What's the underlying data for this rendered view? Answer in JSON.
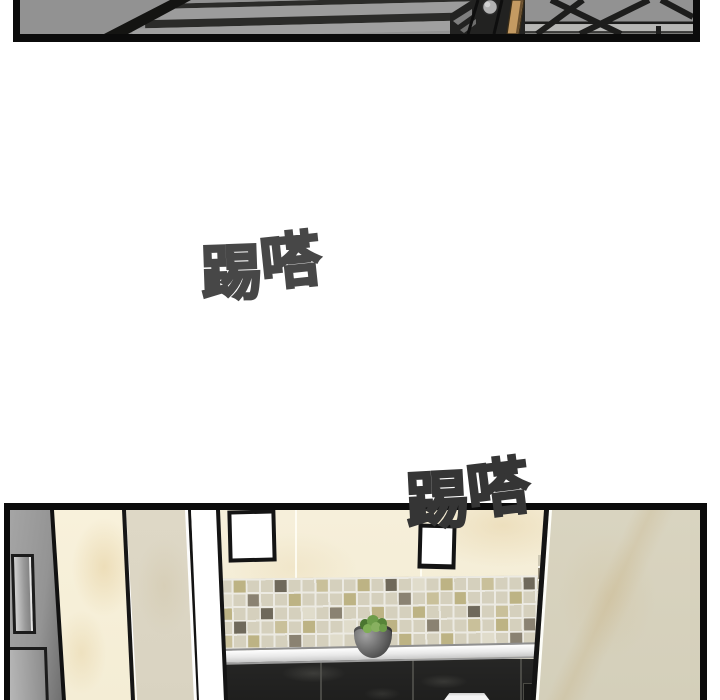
{
  "sfx": {
    "first": {
      "text": "踢嗒",
      "char1": "踢",
      "char2": "嗒",
      "color": "#474747"
    },
    "second": {
      "text": "踢嗒",
      "char1": "踢",
      "char2": "嗒",
      "color": "#353535"
    }
  },
  "colors": {
    "page_bg": "#ffffff",
    "panel_border": "#0b0b0b",
    "stair_gray": "#939393",
    "stair_dark": "#2b2b29",
    "railing_black": "#1d1d1c",
    "rail_wood": "#c49a62",
    "knob_gray": "#b2b2b2",
    "wall_cream": "#f5eed7",
    "column_beige": "#d8d3bf",
    "tile_base": "#d5d0bd",
    "tile_khaki": "#bdb384",
    "tile_dark": "#6f695b",
    "tile_brown": "#8a8272",
    "counter_black": "#232322",
    "ledge_white": "#f5f5f5",
    "plant_green": "#6d9c49",
    "pot_gray": "#6e6e6e"
  }
}
